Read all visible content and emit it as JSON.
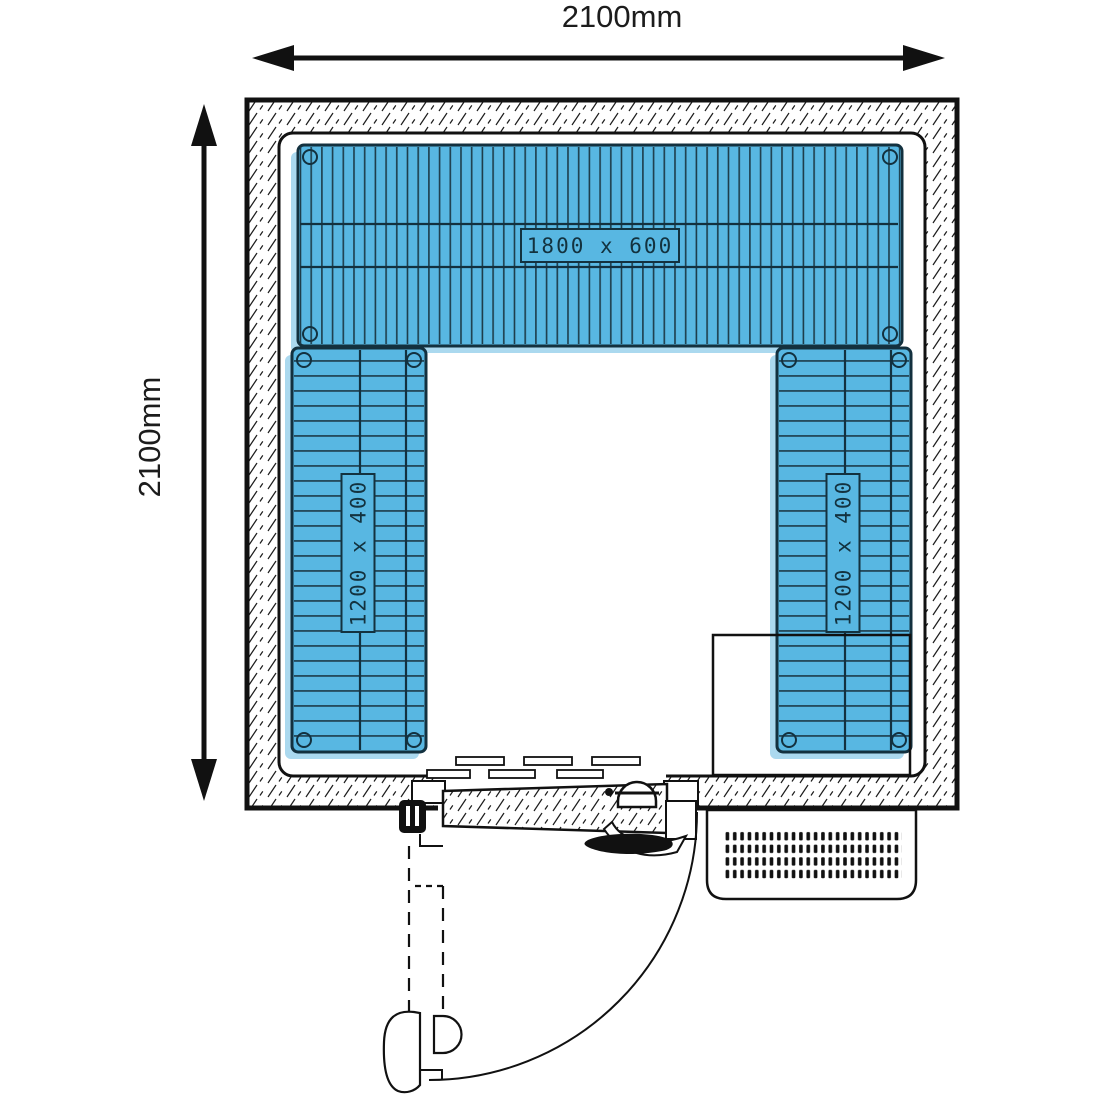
{
  "diagram": {
    "type": "cold-room-floor-plan",
    "dimensions": {
      "width_label": "2100mm",
      "height_label": "2100mm"
    },
    "shelves": [
      {
        "id": "top",
        "label": "1800 x 600"
      },
      {
        "id": "left",
        "label": "1200 x 400"
      },
      {
        "id": "right",
        "label": "1200 x 400"
      }
    ],
    "colors": {
      "shelf_fill": "#58b7e2",
      "shelf_shadow": "#abd9ef",
      "shelf_line": "#1d3c4a",
      "label_text": "#13323f",
      "line": "#111111"
    }
  }
}
